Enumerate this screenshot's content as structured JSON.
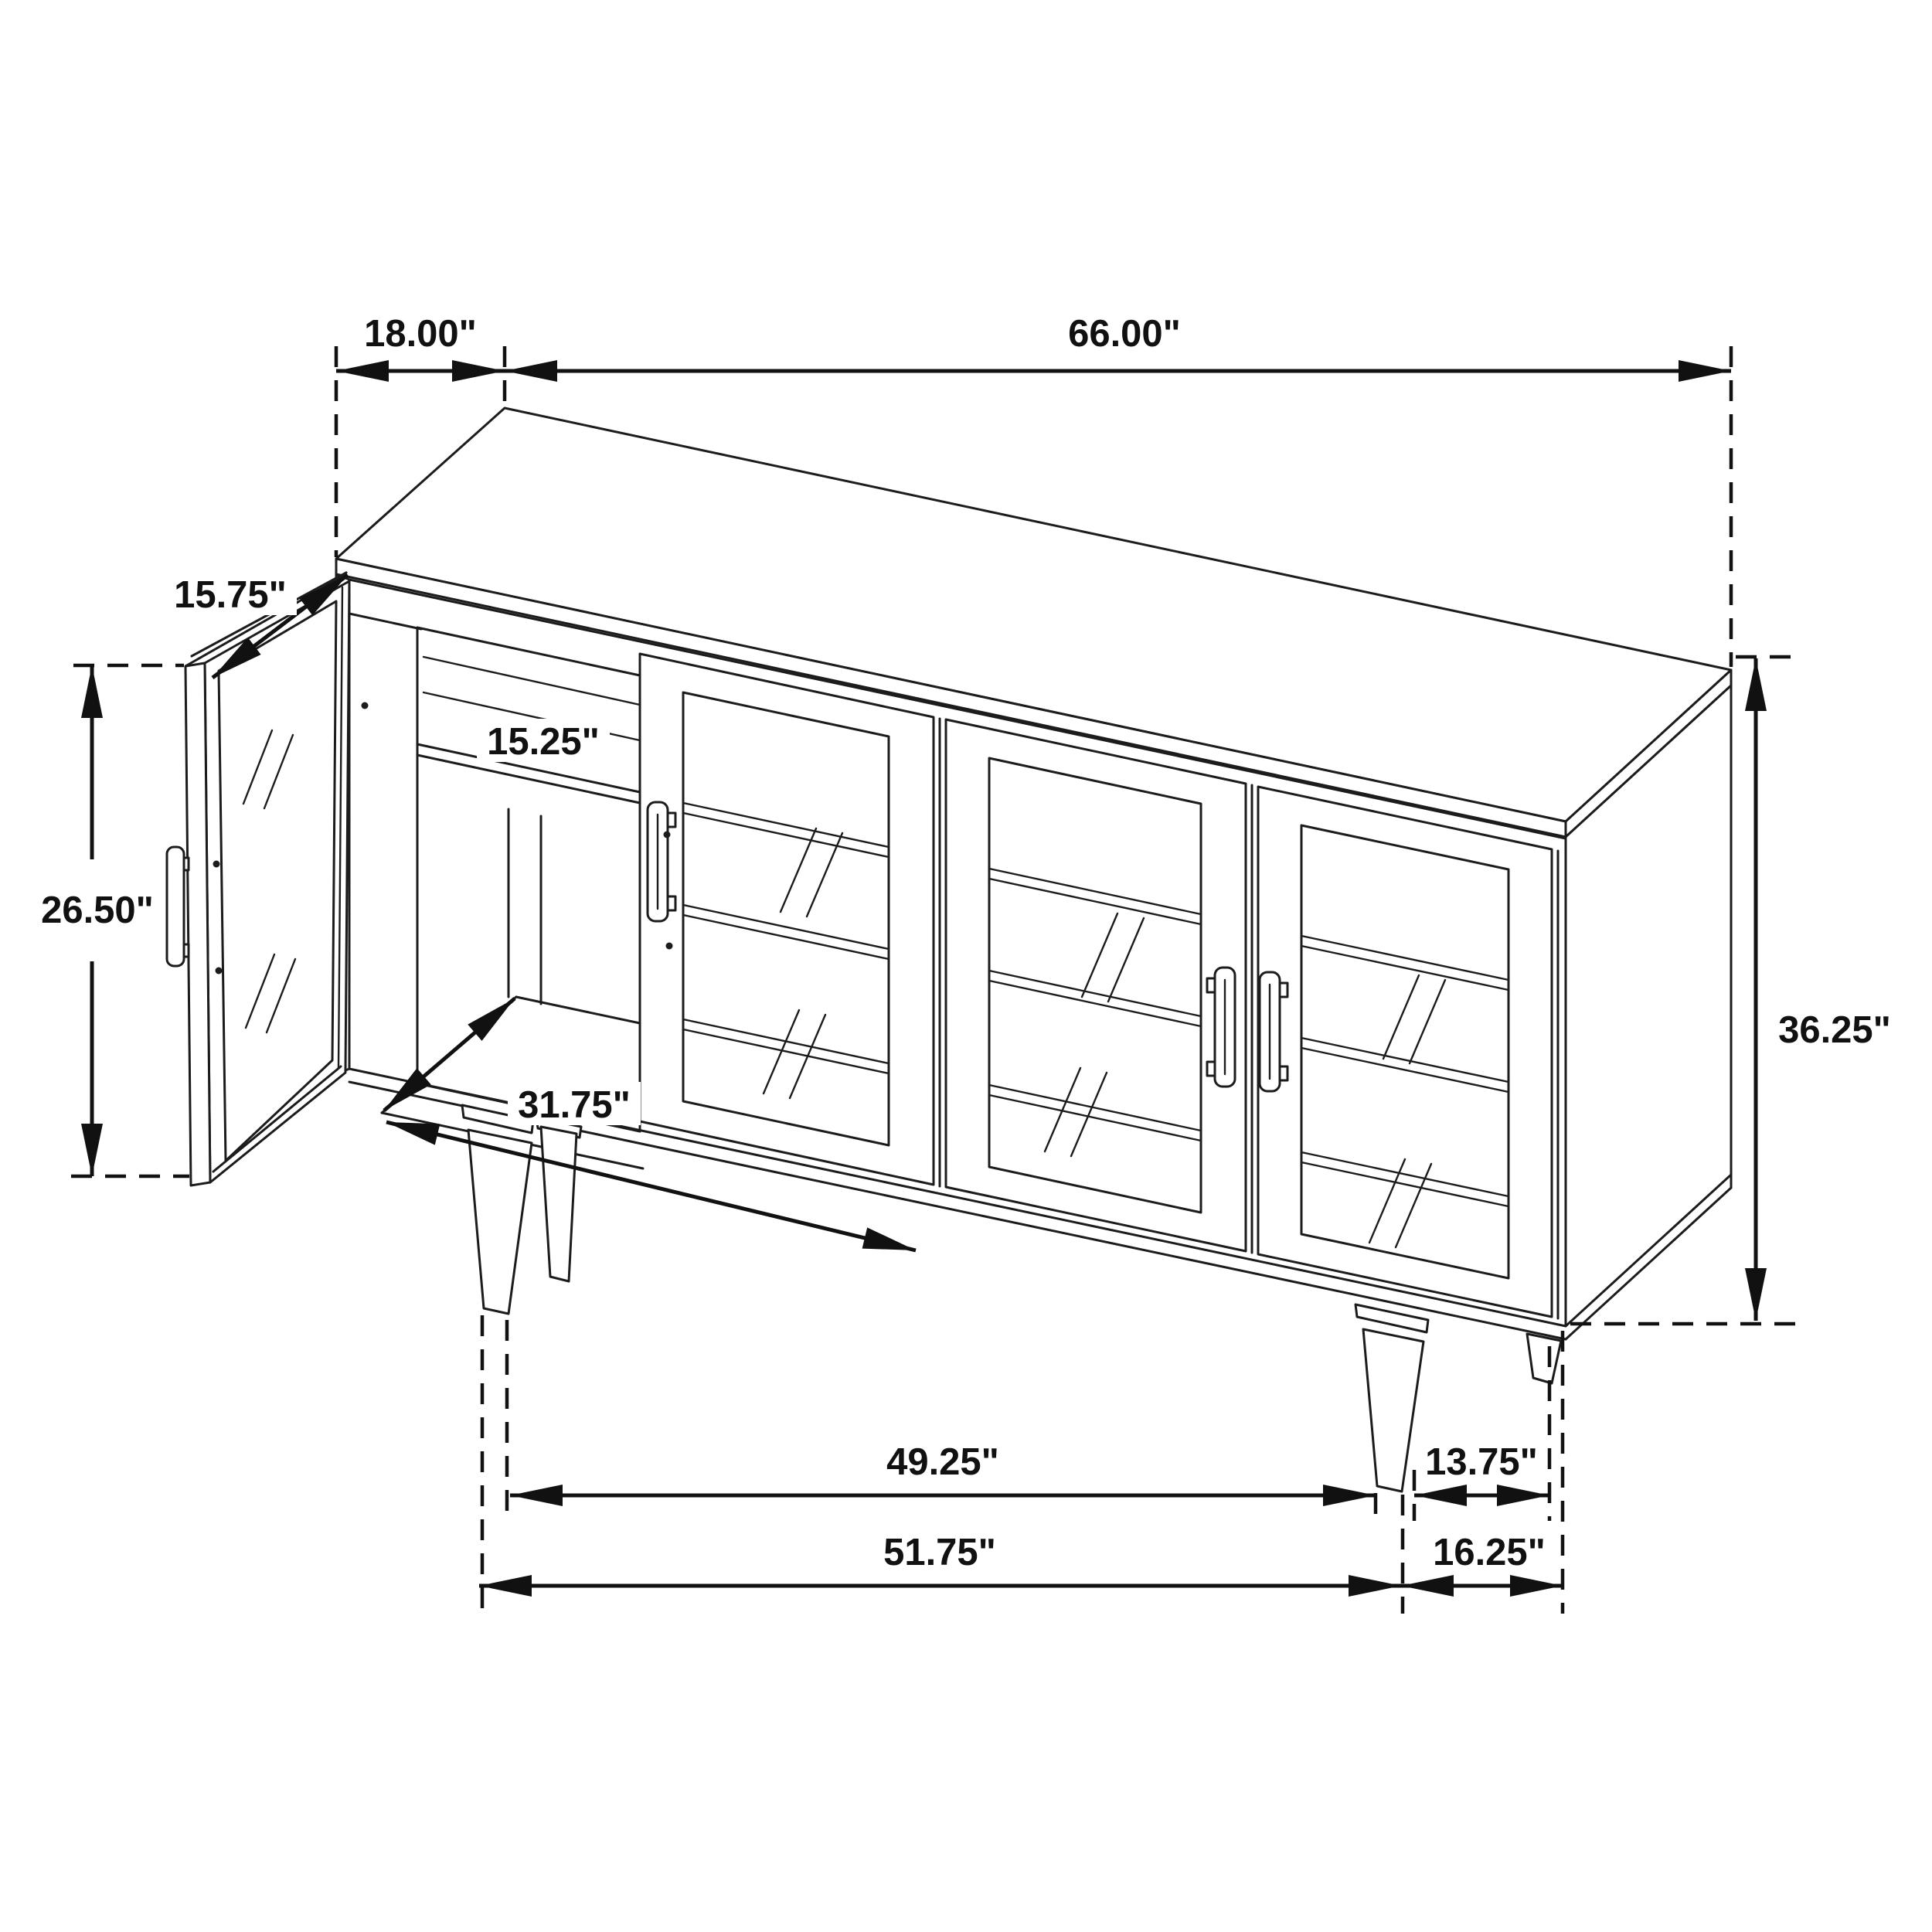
{
  "diagram": {
    "type": "furniture-dimension-drawing",
    "subject": "sideboard cabinet with glass doors, isometric line drawing",
    "colors": {
      "line": "#1c1c1c",
      "dimension": "#111111",
      "background": "#ffffff"
    },
    "dimensions": {
      "top_depth": "18.00\"",
      "overall_width": "66.00\"",
      "door_width": "15.75\"",
      "shelf_depth": "15.25\"",
      "door_height": "26.50\"",
      "interior_width": "31.75\"",
      "overall_height": "36.25\"",
      "leg_span_inner": "49.25\"",
      "leg_to_back": "13.75\"",
      "leg_span_outer": "51.75\"",
      "base_depth": "16.25\""
    }
  }
}
